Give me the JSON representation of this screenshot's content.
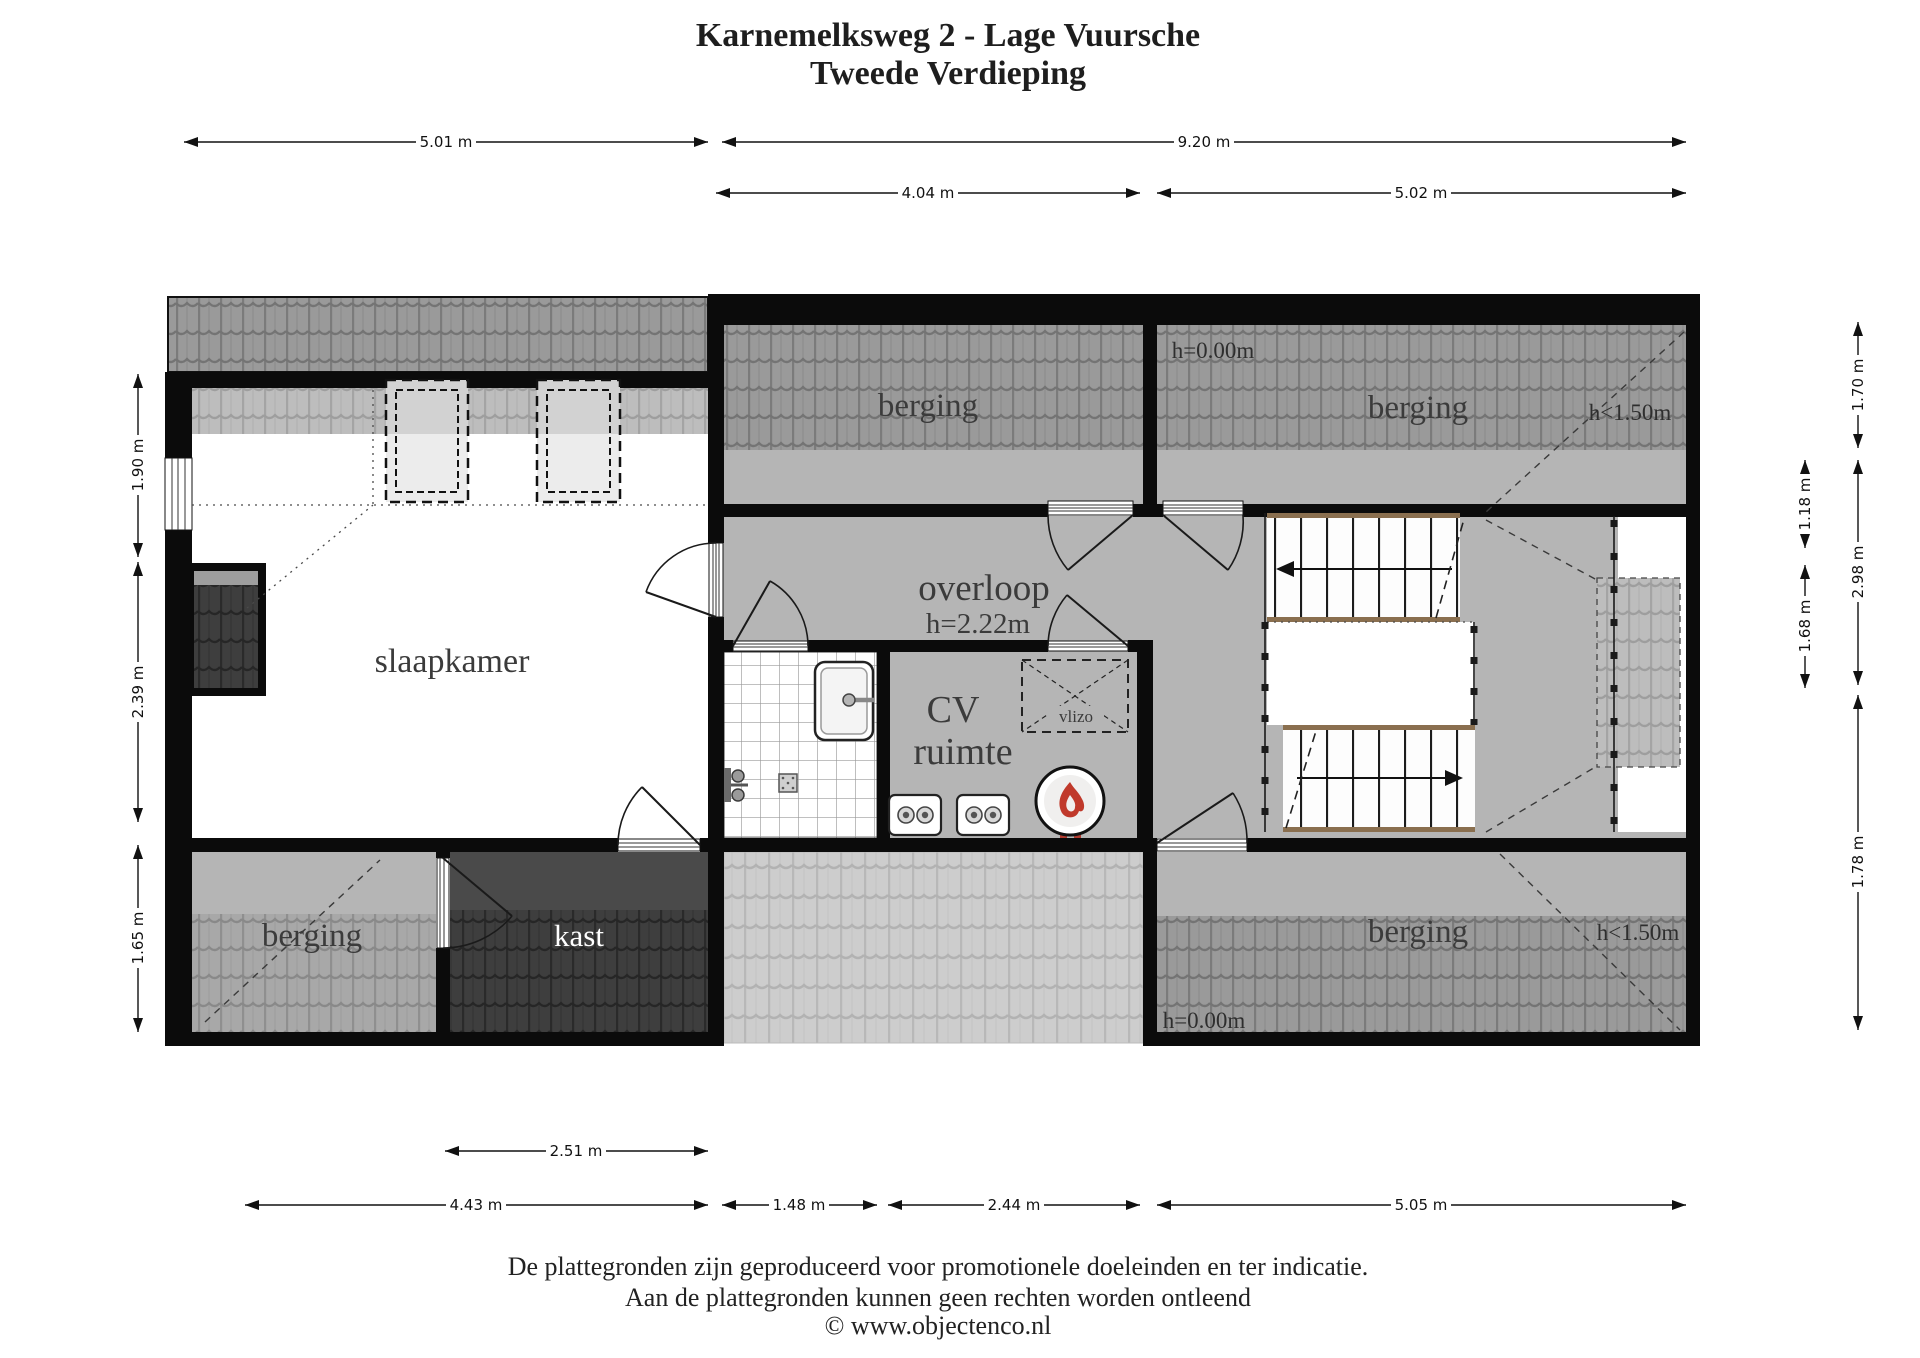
{
  "title": {
    "line1": "Karnemelksweg 2 - Lage Vuursche",
    "line2": "Tweede Verdieping"
  },
  "plan": {
    "rooms": {
      "slaapkamer": "slaapkamer",
      "overloop": "overloop",
      "overloop_height": "h=2.22m",
      "cv_line1": "CV",
      "cv_line2": "ruimte",
      "vlizo": "vlizo",
      "kast": "kast",
      "berging_top_left": "berging",
      "berging_top_right": "berging",
      "berging_bottom_left": "berging",
      "berging_bottom_right": "berging"
    },
    "height_markers": {
      "top_floor": "h=0.00m",
      "top_limit": "h<1.50m",
      "bottom_floor": "h=0.00m",
      "bottom_limit": "h<1.50m"
    }
  },
  "dimensions": {
    "top": [
      {
        "label": "5.01 m"
      },
      {
        "label": "9.20 m"
      },
      {
        "label": "4.04 m"
      },
      {
        "label": "5.02 m"
      }
    ],
    "bottom": [
      {
        "label": "2.51 m"
      },
      {
        "label": "4.43 m"
      },
      {
        "label": "1.48 m"
      },
      {
        "label": "2.44 m"
      },
      {
        "label": "5.05 m"
      }
    ],
    "left": [
      {
        "label": "1.90 m"
      },
      {
        "label": "2.39 m"
      },
      {
        "label": "1.65 m"
      }
    ],
    "right": [
      {
        "label": "1.70 m"
      },
      {
        "label": "2.98 m"
      },
      {
        "label": "1.78 m"
      },
      {
        "label": "1.18 m"
      },
      {
        "label": "1.68 m"
      }
    ]
  },
  "footer": {
    "line1": "De plattegronden zijn geproduceerd voor promotionele doeleinden en ter indicatie.",
    "line2": "Aan de plattegronden kunnen geen rechten worden ontleend",
    "line3": "© www.objectenco.nl"
  },
  "colors": {
    "wall": "#0b0b0b",
    "floor_gray": "#b5b5b5",
    "stair_wood": "#8a6f4f",
    "boiler_flame": "#c0392b"
  }
}
